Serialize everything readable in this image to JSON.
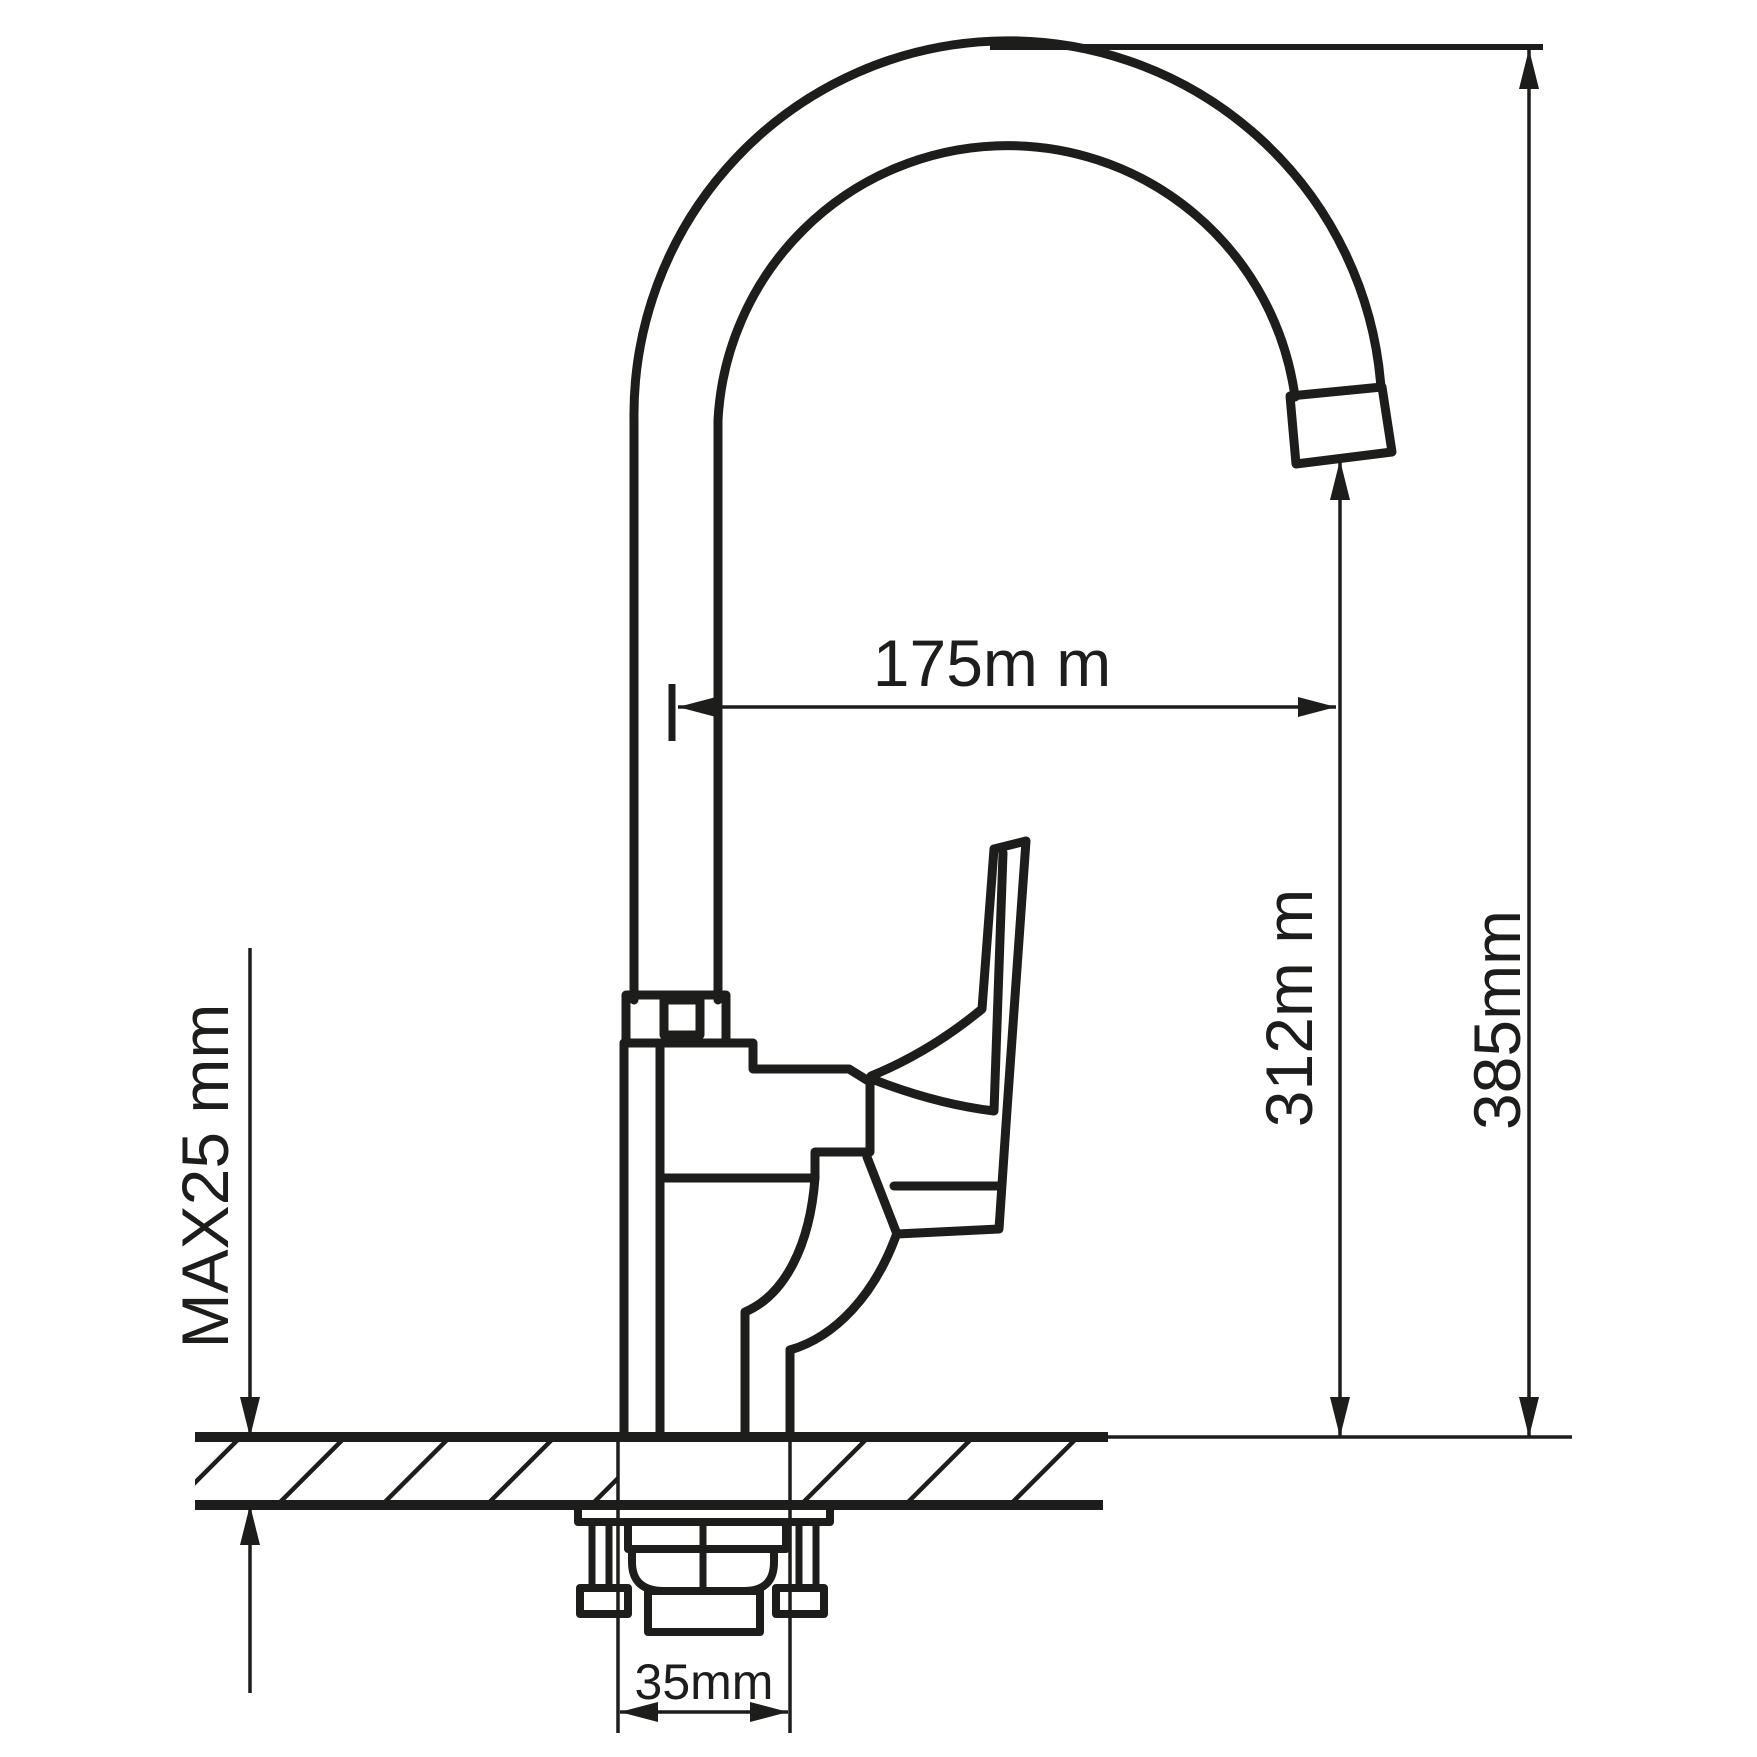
{
  "drawing": {
    "kind": "kitchen-faucet-installation-diagram",
    "colors": {
      "line": "#1d1d1b",
      "background": "#ffffff"
    },
    "dimensions": {
      "spout_reach": {
        "label": "175m m",
        "value_mm": 175
      },
      "outlet_height": {
        "label": "312m m",
        "value_mm": 312
      },
      "overall_height": {
        "label": "385mm",
        "value_mm": 385
      },
      "max_deck_thickness": {
        "label": "MAX25 mm",
        "value_mm": 25
      },
      "mounting_hole": {
        "label": "35mm",
        "value_mm": 35
      }
    }
  }
}
